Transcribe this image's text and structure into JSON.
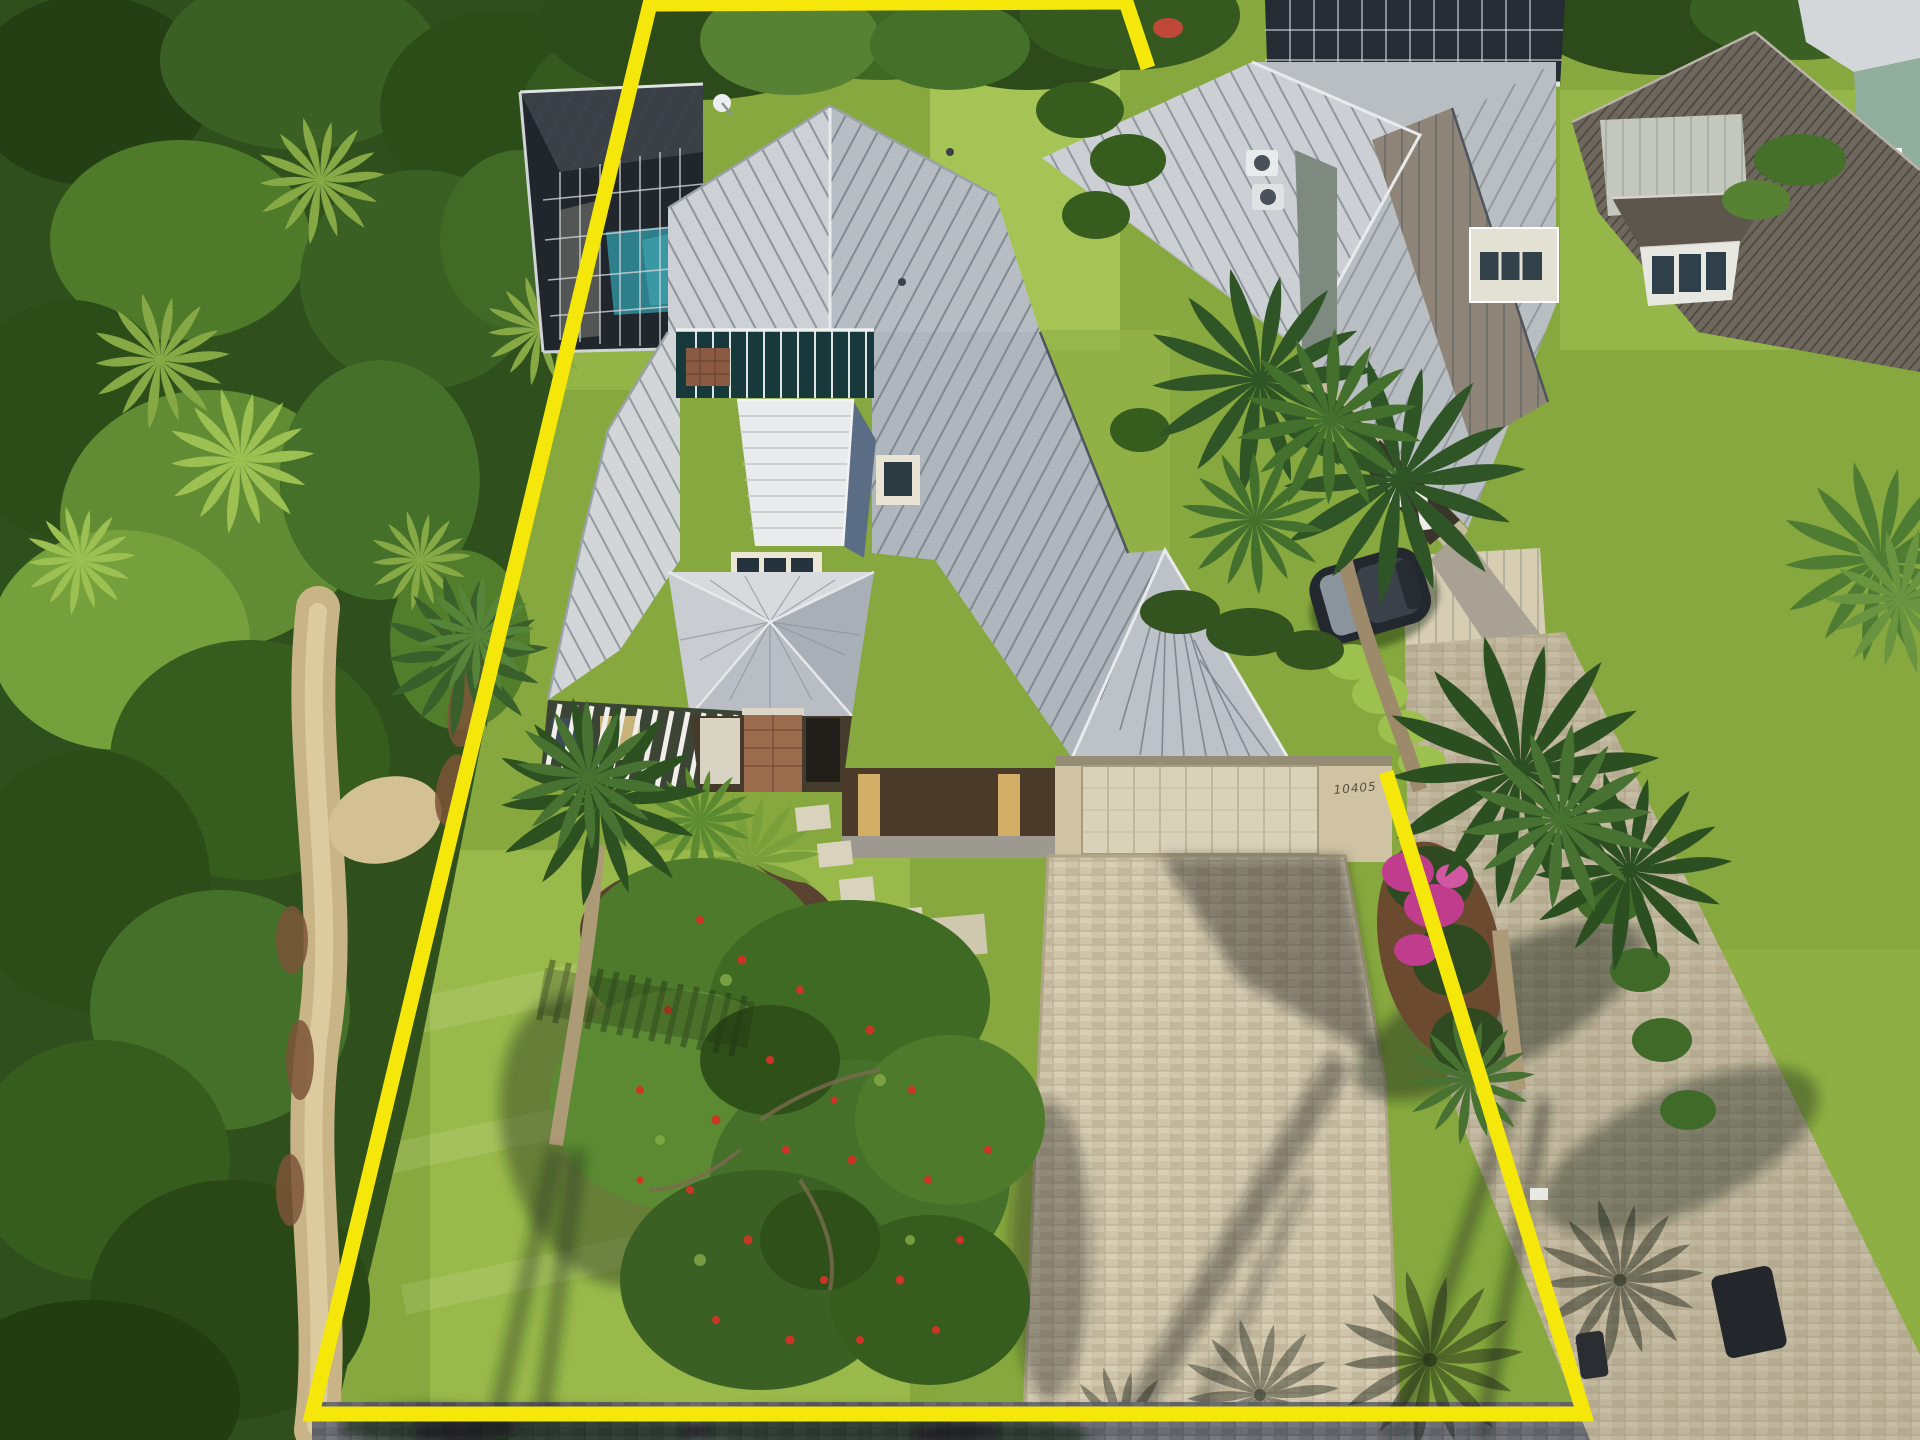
{
  "scene": {
    "type": "aerial-drone-real-estate-photo",
    "house_number": "10405"
  },
  "boundary": {
    "color": "#f6e70a",
    "stroke_width": 15,
    "points": "1148,68 1126,2 650,4 312,1414 1584,1414 1386,772"
  },
  "palette": {
    "boundary_yellow": "#f6e70a",
    "grass": "#86a83e",
    "grass_bright": "#a5c455",
    "forest_green": "#2f4f1c",
    "roof_light": "#cdd1d5",
    "roof_mid": "#b4bac0",
    "roof_shadow": "#5b6d85",
    "pool_water": "#2e7f8c",
    "paver_light": "#cfc5ab",
    "paver_road": "#6b6d73",
    "wall_beige": "#cfc3a4",
    "garage_door": "#d9d1b8",
    "mulch_brown": "#6b4a30",
    "bougainvillea_pink": "#bf3d8c",
    "fruit_red": "#cc3526",
    "palm_green": "#2f5a26",
    "trunk_tan": "#ad9a77"
  }
}
